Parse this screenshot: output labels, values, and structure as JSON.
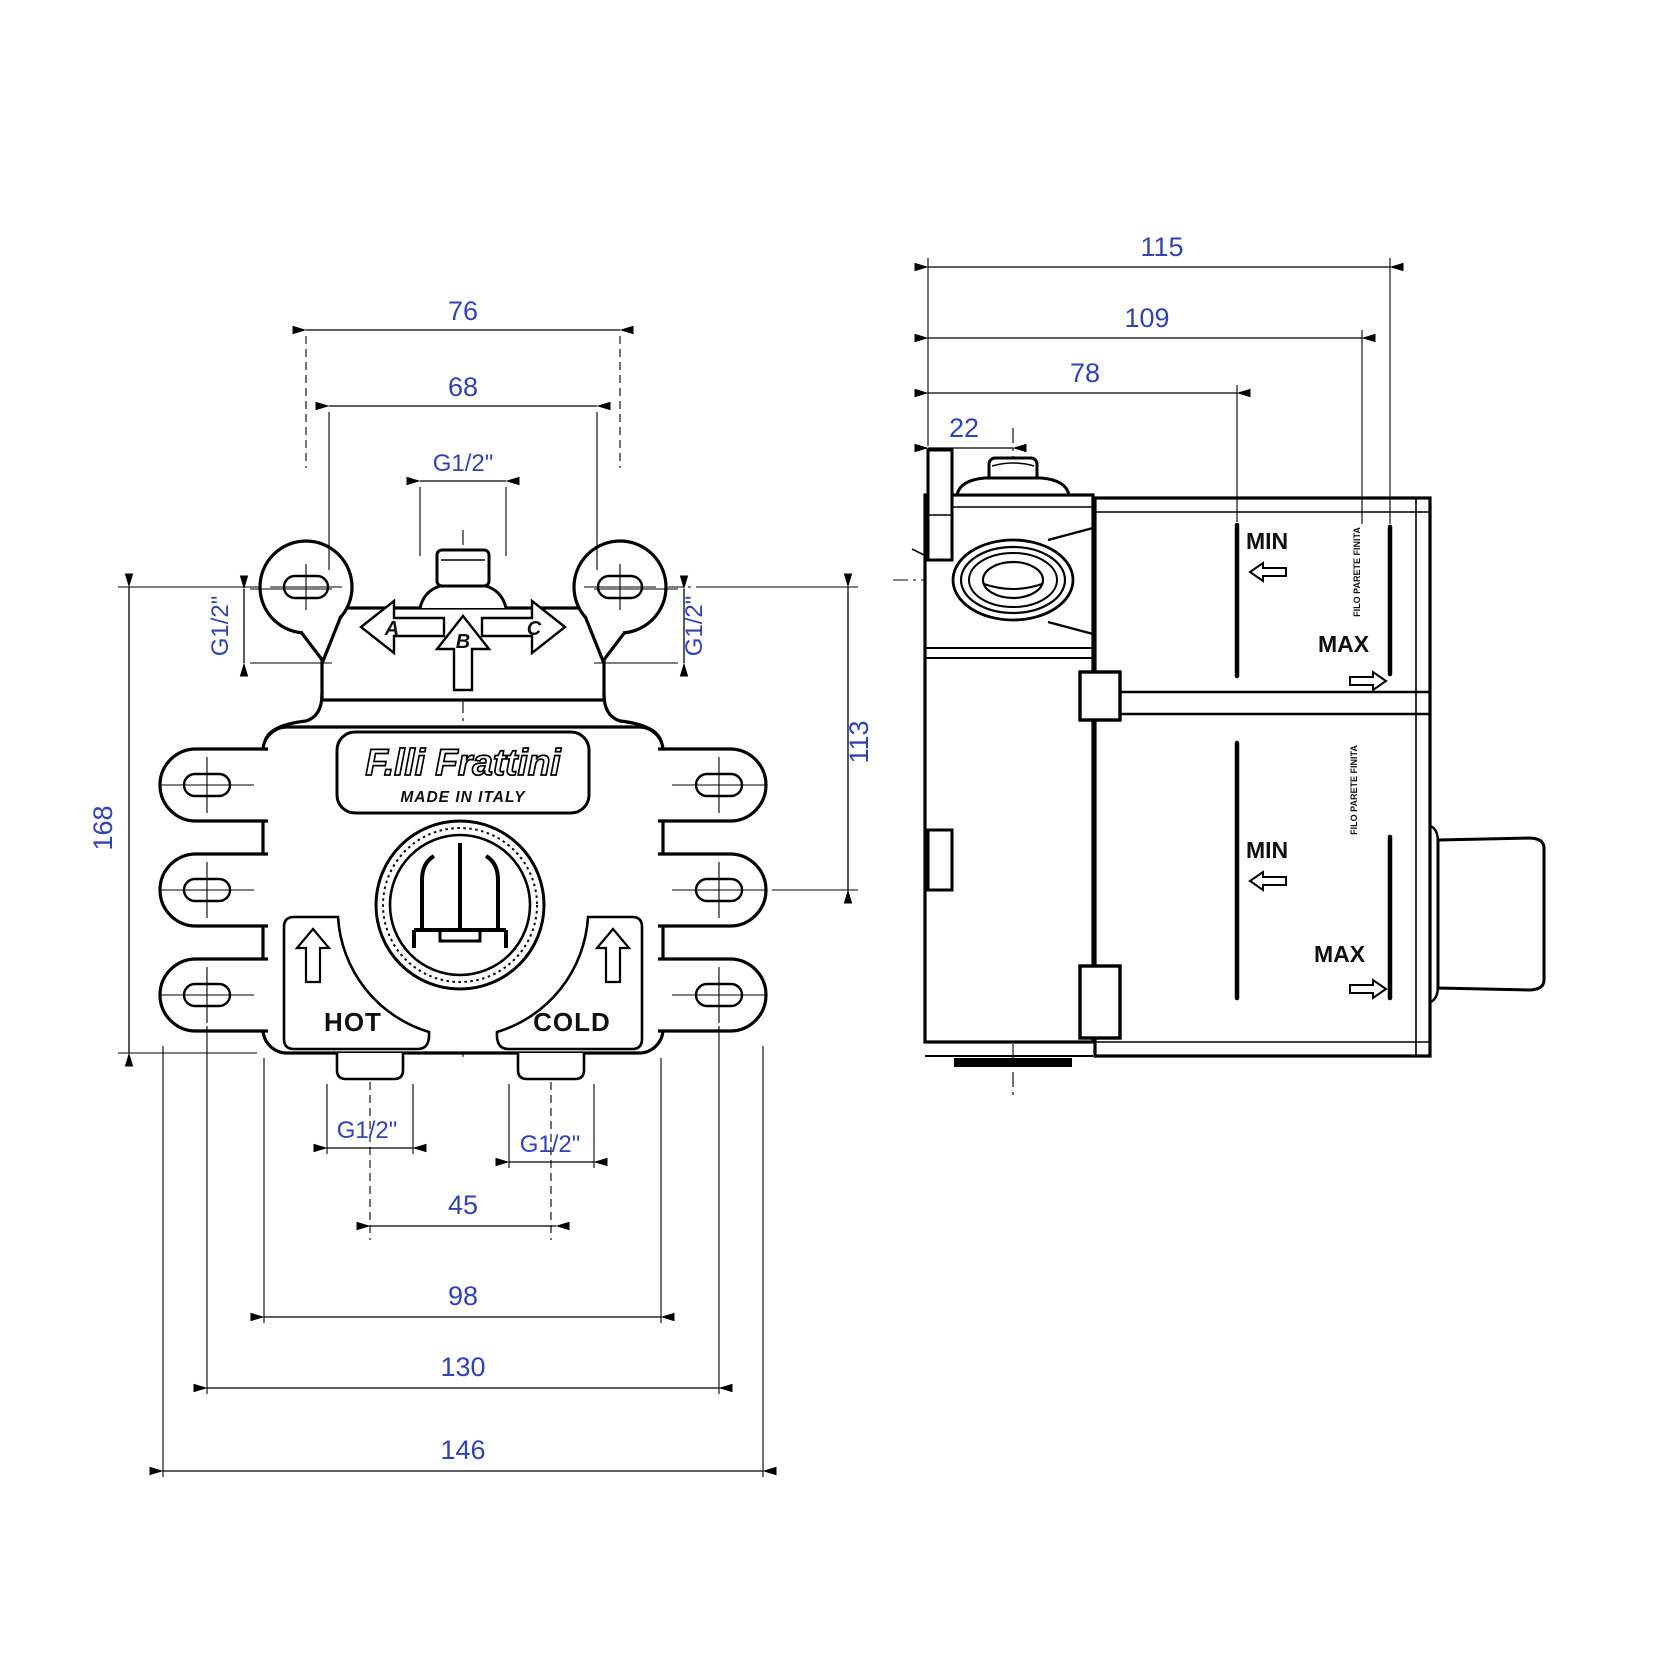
{
  "brand_plate": {
    "name": "F.lli Frattini",
    "origin": "MADE IN ITALY"
  },
  "front_view": {
    "dim_top_width": "76",
    "dim_inner_width": "68",
    "dim_top_port": "G1/2\"",
    "dim_side_port_left": "G1/2\"",
    "dim_side_port_right": "G1/2\"",
    "dim_height": "168",
    "dim_right_height": "113",
    "dim_hot_port": "G1/2\"",
    "dim_cold_port": "G1/2\"",
    "dim_port_spacing": "45",
    "dim_body_width": "98",
    "dim_slot_spacing": "130",
    "dim_overall_width": "146",
    "outlet_a": "A",
    "outlet_b": "B",
    "outlet_c": "C",
    "hot_label": "HOT",
    "cold_label": "COLD"
  },
  "side_view": {
    "dim_overall_depth": "115",
    "dim_depth_to_max": "109",
    "dim_depth_to_min": "78",
    "dim_stem_offset": "22",
    "min_label": "MIN",
    "max_label": "MAX",
    "wall_note": "FILO PARETE FINITA"
  },
  "colors": {
    "line": "#000000",
    "dim_text": "#3142b5"
  }
}
